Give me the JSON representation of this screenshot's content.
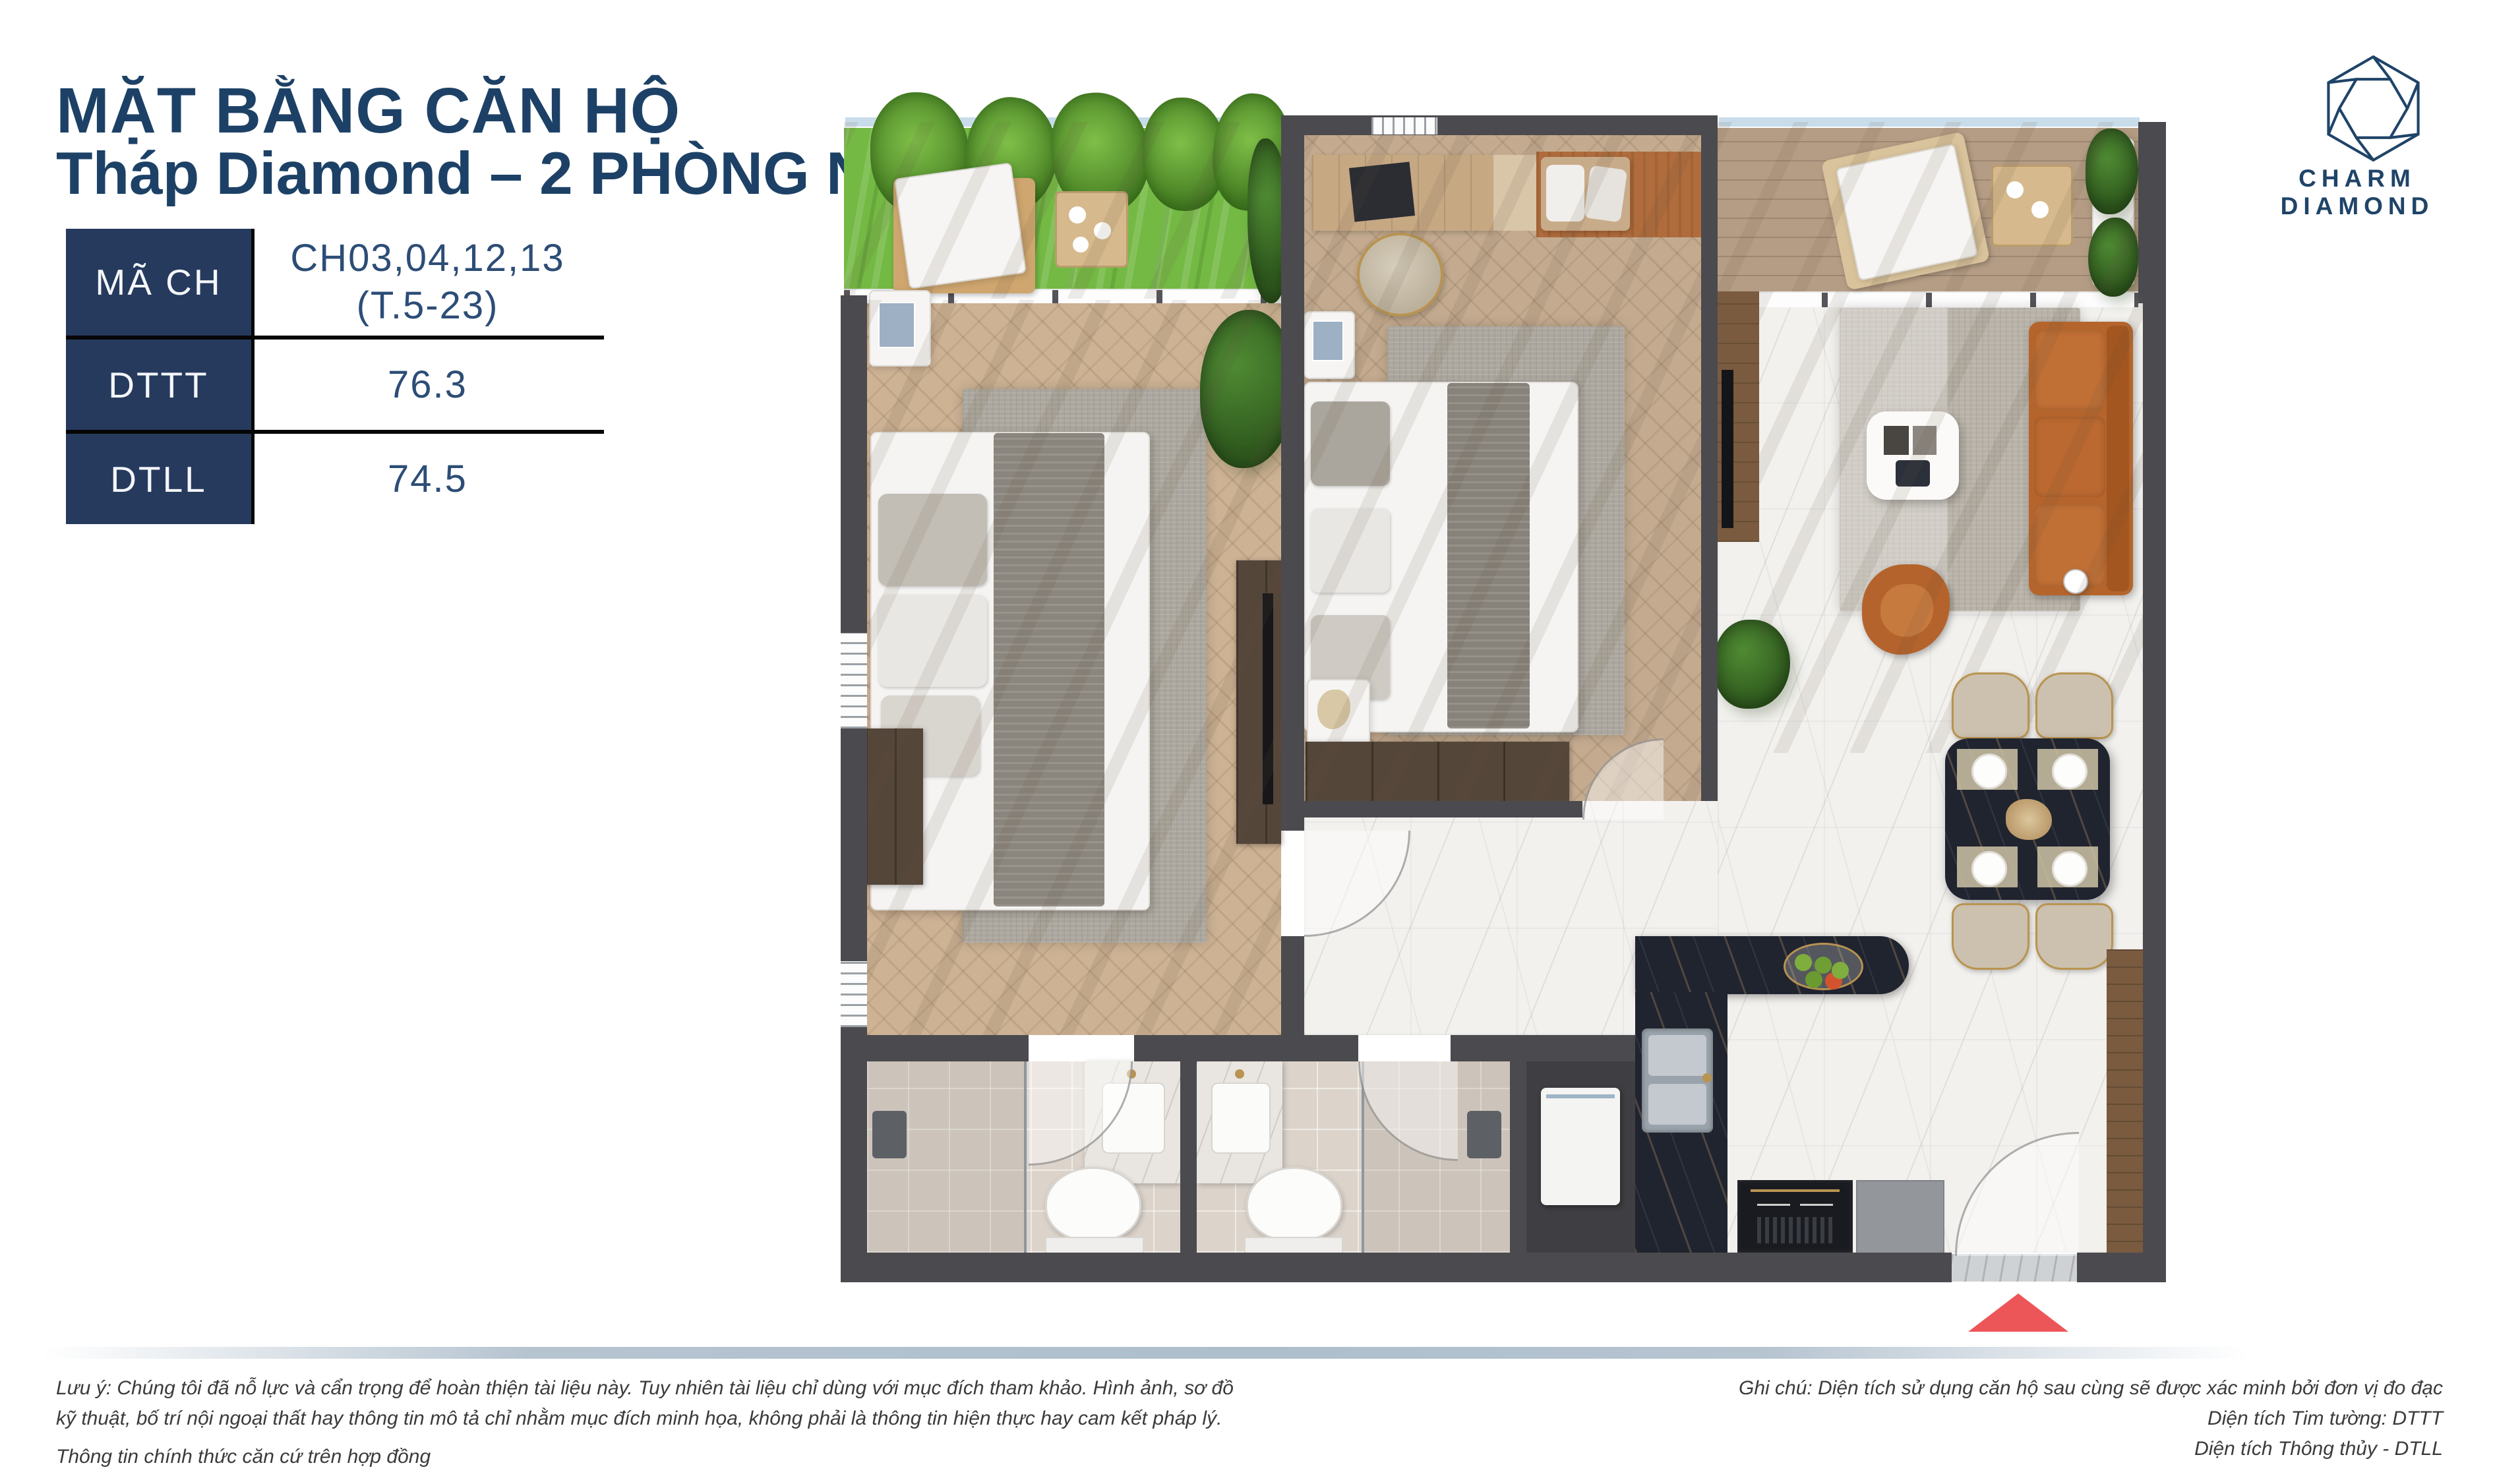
{
  "header": {
    "title_line1": "MẶT BẰNG CĂN HỘ",
    "title_line2": "Tháp Diamond – 2 PHÒNG NGỦ"
  },
  "info_table": {
    "rows": [
      {
        "label": "MÃ CH",
        "value_line1": "CH03,04,12,13",
        "value_line2": "(T.5-23)"
      },
      {
        "label": "DTTT",
        "value": "76.3"
      },
      {
        "label": "DTLL",
        "value": "74.5"
      }
    ]
  },
  "brand": {
    "logo_text": "CHARM DIAMOND",
    "logo_icon": "hexagon-diamond-icon"
  },
  "floor_plan": {
    "type": "2-bedroom apartment top-view render",
    "entrance_arrow_color": "#ed5659"
  },
  "footer": {
    "left_lines": [
      "Lưu ý: Chúng tôi đã nỗ lực và cẩn trọng để hoàn thiện tài liệu này. Tuy nhiên tài liệu chỉ dùng với mục đích tham khảo. Hình ảnh, sơ đồ",
      "kỹ thuật, bố trí nội ngoại thất hay thông tin mô tả chỉ nhằm mục đích minh họa, không phải là thông tin hiện thực hay cam kết pháp lý.",
      "Thông tin chính thức căn cứ trên hợp đồng"
    ],
    "right_lines": [
      "Ghi chú: Diện tích sử dụng căn hộ sau cùng sẽ được xác minh bởi đơn vị đo đạc",
      "Diện tích Tim tường: DTTT",
      "Diện tích Thông thủy - DTLL"
    ]
  },
  "colors": {
    "accent_navy": "#1d4166",
    "table_header_bg": "#263a5e",
    "wall_gray": "#4b4a4e",
    "grass_green": "#74b944",
    "sofa_orange": "#b5652c",
    "arrow_red": "#ed5659",
    "divider_bar": "#b6c4d0"
  }
}
